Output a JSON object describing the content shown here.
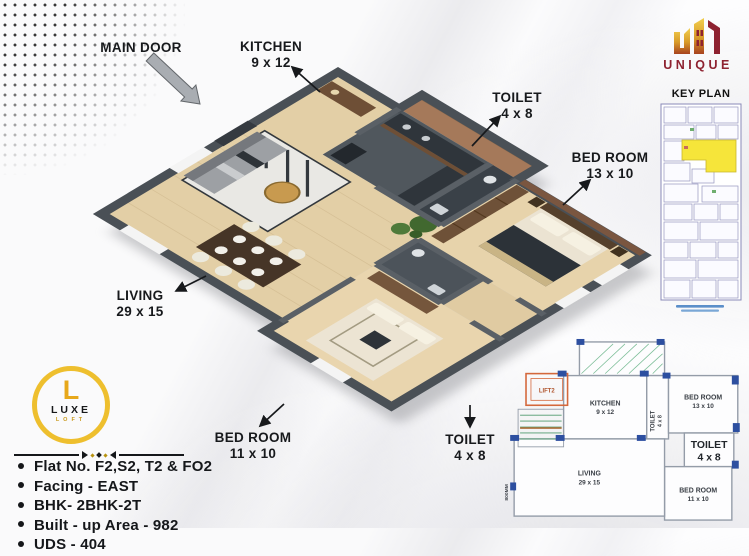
{
  "brand_unique": {
    "name": "UNIQUE",
    "colors": {
      "gold": "#dfa22d",
      "maroon": "#8e2230"
    }
  },
  "key_plan": {
    "title": "KEY PLAN",
    "highlight_color": "#f6e53a"
  },
  "labels_3d": {
    "main_door": {
      "name": "MAIN DOOR"
    },
    "kitchen": {
      "name": "KITCHEN",
      "size": "9 x 12"
    },
    "toilet_top": {
      "name": "TOILET",
      "size": "4 x 8"
    },
    "bedroom_right": {
      "name": "BED ROOM",
      "size": "13 x 10"
    },
    "living": {
      "name": "LIVING",
      "size": "29 x 15"
    },
    "bedroom_bottom": {
      "name": "BED ROOM",
      "size": "11 x 10"
    },
    "toilet_bottom": {
      "name": "TOILET",
      "size": "4 x 8"
    }
  },
  "mini_plan": {
    "kitchen": {
      "name": "KITCHEN",
      "size": "9 x 12"
    },
    "toilet_small": {
      "name": "TOILET",
      "size": "4 x 8"
    },
    "bedroom_13": {
      "name": "BED ROOM",
      "size": "13 x 10"
    },
    "toilet_big": {
      "name": "TOILET",
      "size": "4 x 8"
    },
    "living": {
      "name": "LIVING",
      "size": "29 x 15"
    },
    "bedroom_11": {
      "name": "BED ROOM",
      "size": "11 x 10"
    },
    "lift": "LIFT2",
    "dim_left": "800MM"
  },
  "luxe_logo": {
    "letter": "L",
    "title": "LUXE",
    "subtitle": "LOFT"
  },
  "details": {
    "items": [
      "Flat No. F2,S2, T2 & FO2",
      "Facing - EAST",
      "BHK- 2BHK-2T",
      "Built - up Area - 982",
      "UDS - 404"
    ]
  }
}
